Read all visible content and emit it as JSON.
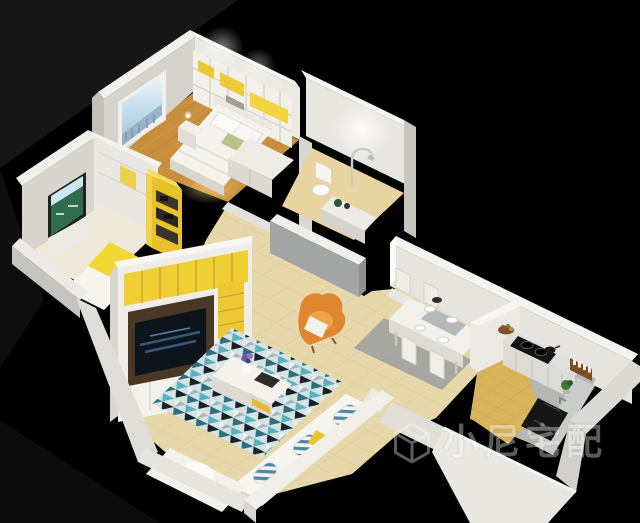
{
  "image": {
    "kind": "3d-isometric-apartment-floorplan-render",
    "width": 640,
    "height": 523,
    "background_color": "#000000"
  },
  "watermark": {
    "icon": "cube-logo",
    "text": "小尼宅配",
    "color": "#ffffff",
    "opacity": 0.36
  },
  "palette": {
    "background": "#000000",
    "wall_white": "#eceae4",
    "wall_top_edge": "#f6f5f1",
    "wall_shadow": "#b3b1ab",
    "accent_yellow": "#ecca35",
    "wood_floor": "#c8903e",
    "tile_beige": "#e7d8ab",
    "kitchen_tile_tan": "#d8b45c",
    "counter_gray": "#c2c5c2",
    "rug_teal": "#56b2c0",
    "rug_dark_teal": "#2c7080",
    "rug_navy": "#152029",
    "armchair_orange": "#e0862e",
    "tv_panel_brown": "#4a3827",
    "tv_screen": "#0e141c",
    "appliance_black": "#141412",
    "window_sky": "#b9d4e6"
  },
  "rooms": [
    {
      "name": "master-bedroom",
      "floor": "wood",
      "furniture": [
        "double-bed",
        "white-pillows",
        "green-cushion",
        "headboard-shelving-with-yellow-boxes",
        "nightstand-with-lamp",
        "wardrobe",
        "window-with-city-view"
      ]
    },
    {
      "name": "second-bedroom",
      "floor": "cream",
      "furniture": [
        "wall-screen-green-picture",
        "low-cabinet",
        "yellow-floor-mat",
        "white-bedding",
        "tall-yellow-shelf"
      ]
    },
    {
      "name": "bathroom",
      "floor": "beige-tile",
      "furniture": [
        "toilet",
        "shower-fixture",
        "vanity-counter",
        "gray-half-wall",
        "ceiling-light"
      ]
    },
    {
      "name": "living-room",
      "floor": "beige-tile",
      "furniture": [
        "tv-wall-unit-yellow-cubes",
        "television",
        "geometric-triangle-rug",
        "coffee-table",
        "purple-flower-vase",
        "l-shaped-white-sofa",
        "striped-pillows",
        "yellow-pillow",
        "orange-armchair"
      ]
    },
    {
      "name": "dining-area",
      "floor": "beige-tile",
      "furniture": [
        "white-dining-table",
        "four-chairs",
        "place-settings",
        "gray-rug"
      ]
    },
    {
      "name": "kitchen",
      "floor": "tan-tile",
      "furniture": [
        "l-shaped-counter",
        "black-gas-cooktop",
        "cooking-pot",
        "black-sink",
        "fruit-basket",
        "spice-rack",
        "potted-plant",
        "divider-wall"
      ]
    }
  ]
}
